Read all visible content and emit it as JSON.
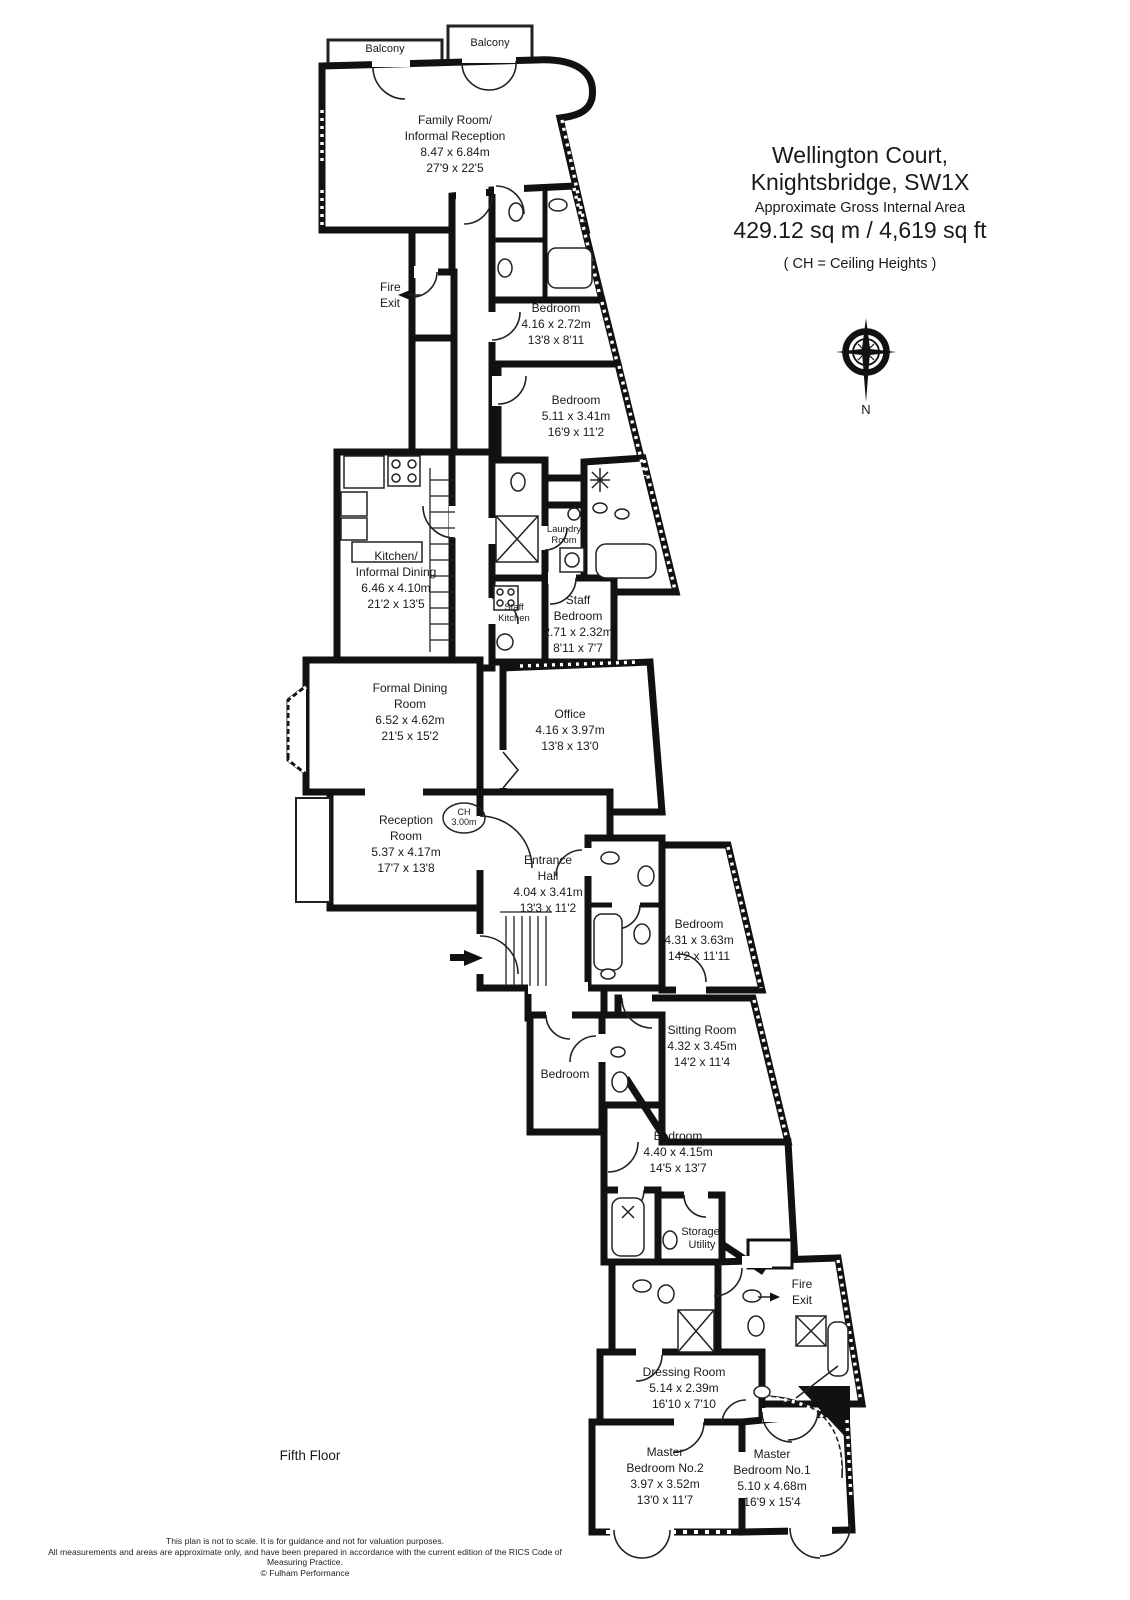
{
  "title": {
    "address_line1": "Wellington Court,",
    "address_line2": "Knightsbridge, SW1X",
    "area_label": "Approximate Gross Internal Area",
    "area_value": "429.12 sq m  /  4,619 sq ft",
    "ch_note": "( CH = Ceiling Heights )"
  },
  "floor_label": "Fifth Floor",
  "compass": {
    "north": "N"
  },
  "labels": {
    "balcony_a": "Balcony",
    "balcony_b": "Balcony",
    "fire_exit_top": [
      "Fire",
      "Exit"
    ],
    "fire_exit_bottom": [
      "Fire",
      "Exit"
    ],
    "ch_badge": [
      "CH",
      "3.00m"
    ]
  },
  "rooms": {
    "family_room": [
      "Family Room/",
      "Informal Reception",
      "8.47 x 6.84m",
      "27'9 x 22'5"
    ],
    "bedroom_1": [
      "Bedroom",
      "4.16 x 2.72m",
      "13'8 x 8'11"
    ],
    "bedroom_2": [
      "Bedroom",
      "5.11 x 3.41m",
      "16'9 x 11'2"
    ],
    "kitchen": [
      "Kitchen/",
      "Informal Dining",
      "6.46 x 4.10m",
      "21'2 x 13'5"
    ],
    "laundry_room": [
      "Laundry",
      "Room"
    ],
    "staff_kitchen": [
      "Staff",
      "Kitchen"
    ],
    "staff_bedroom": [
      "Staff",
      "Bedroom",
      "2.71 x 2.32m",
      "8'11 x 7'7"
    ],
    "office": [
      "Office",
      "4.16 x 3.97m",
      "13'8 x 13'0"
    ],
    "formal_dining_room": [
      "Formal Dining",
      "Room",
      "6.52 x 4.62m",
      "21'5 x 15'2"
    ],
    "reception_room": [
      "Reception",
      "Room",
      "5.37 x 4.17m",
      "17'7 x 13'8"
    ],
    "entrance_hall": [
      "Entrance",
      "Hall",
      "4.04 x 3.41m",
      "13'3 x 11'2"
    ],
    "bedroom_3": [
      "Bedroom",
      "4.31 x 3.63m",
      "14'2 x 11'11"
    ],
    "sitting_room": [
      "Sitting Room",
      "4.32 x 3.45m",
      "14'2 x 11'4"
    ],
    "bedroom_4": [
      "Bedroom"
    ],
    "bedroom_5": [
      "Bedroom",
      "4.40 x 4.15m",
      "14'5 x 13'7"
    ],
    "storage_utility": [
      "Storage/",
      "Utility"
    ],
    "dressing_room": [
      "Dressing Room",
      "5.14 x 2.39m",
      "16'10 x 7'10"
    ],
    "master_bedroom_2": [
      "Master",
      "Bedroom No.2",
      "3.97 x 3.52m",
      "13'0 x 11'7"
    ],
    "master_bedroom_1": [
      "Master",
      "Bedroom No.1",
      "5.10 x 4.68m",
      "16'9 x 15'4"
    ]
  },
  "footer": {
    "line1": "This plan is not to scale. It is for guidance and not for valuation purposes.",
    "line2": "All measurements and areas are approximate only, and have been prepared in accordance with the current edition of the RICS Code of Measuring Practice.",
    "line3": "© Fulham Performance"
  },
  "colors": {
    "wall": "#111111",
    "background": "#ffffff",
    "text": "#1a1a1a"
  }
}
